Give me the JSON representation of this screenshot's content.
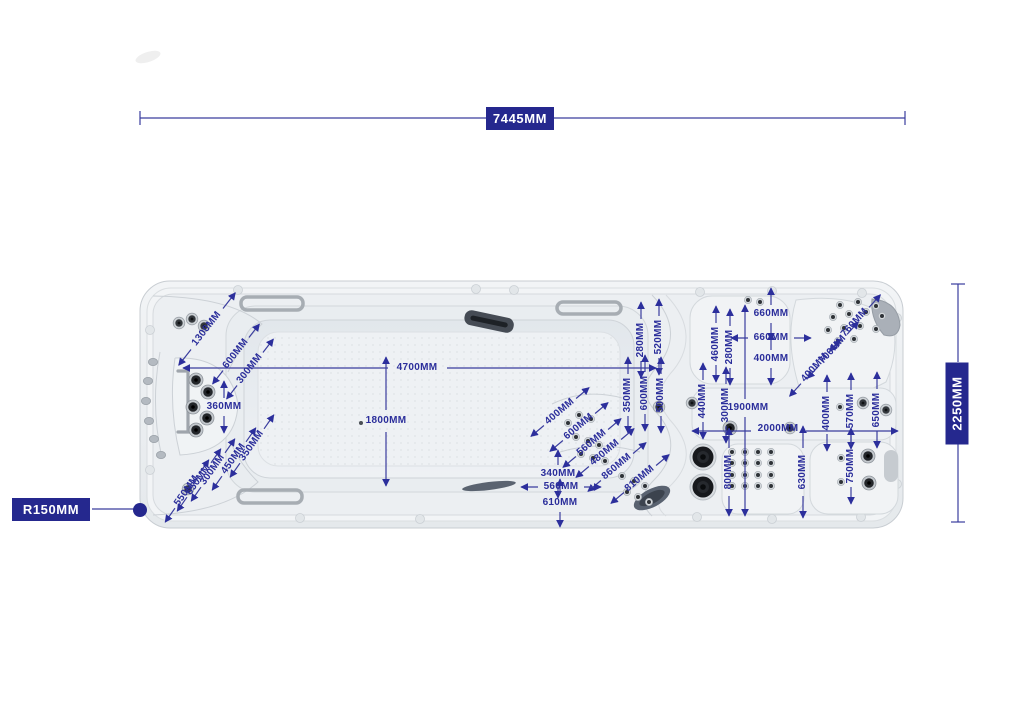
{
  "title": "Swim spa top-view dimension diagram",
  "colors": {
    "dimension_text": "#2b2e9b",
    "dimension_line": "#3a3d9e",
    "box_bg": "#25288e",
    "box_text": "#ffffff",
    "shell": "#eef0f2",
    "outline": "#c8cdd2"
  },
  "overall_dimensions": {
    "length": "7445MM",
    "width": "2250MM",
    "corner_radius": "R150MM"
  },
  "dimension_labels": [
    {
      "label": "1300MM",
      "x": 207,
      "y": 329,
      "r": -52,
      "ar": -52,
      "gap": 26,
      "len": 46
    },
    {
      "label": "600MM",
      "x": 236,
      "y": 354,
      "r": -52,
      "ar": -52,
      "gap": 21,
      "len": 38
    },
    {
      "label": "300MM",
      "x": 250,
      "y": 369,
      "r": -52,
      "ar": -52,
      "gap": 21,
      "len": 38
    },
    {
      "label": "360MM",
      "x": 224,
      "y": 407,
      "r": 0,
      "ar": -90,
      "gap": 9,
      "len": 26
    },
    {
      "label": "4700MM",
      "x": 417,
      "y": 368,
      "r": 0,
      "arrows": false
    },
    {
      "label": "1800MM",
      "x": 386,
      "y": 421,
      "r": 0,
      "arrows": false
    },
    {
      "label": "350MM",
      "x": 252,
      "y": 446,
      "r": -55,
      "ar": -55,
      "gap": 21,
      "len": 38
    },
    {
      "label": "450MM",
      "x": 234,
      "y": 459,
      "r": -55,
      "ar": -55,
      "gap": 21,
      "len": 38
    },
    {
      "label": "300MM",
      "x": 213,
      "y": 470,
      "r": -55,
      "ar": -55,
      "gap": 21,
      "len": 38
    },
    {
      "label": "650MM",
      "x": 199,
      "y": 480,
      "r": -55,
      "ar": -55,
      "gap": 21,
      "len": 38
    },
    {
      "label": "550MM",
      "x": 187,
      "y": 491,
      "r": -55,
      "ar": -55,
      "gap": 21,
      "len": 38
    },
    {
      "label": "280MM",
      "x": 641,
      "y": 340,
      "r": -90,
      "ar": -90,
      "gap": 21,
      "len": 38
    },
    {
      "label": "520MM",
      "x": 659,
      "y": 337,
      "r": -90,
      "ar": -90,
      "gap": 21,
      "len": 38
    },
    {
      "label": "350MM",
      "x": 628,
      "y": 395,
      "r": -90,
      "ar": -90,
      "gap": 21,
      "len": 38
    },
    {
      "label": "600MM",
      "x": 645,
      "y": 393,
      "r": -90,
      "ar": -90,
      "gap": 21,
      "len": 38
    },
    {
      "label": "500MM",
      "x": 661,
      "y": 395,
      "r": -90,
      "ar": -90,
      "gap": 21,
      "len": 38
    },
    {
      "label": "400MM",
      "x": 560,
      "y": 412,
      "r": -40,
      "ar": -40,
      "gap": 21,
      "len": 38
    },
    {
      "label": "600MM",
      "x": 579,
      "y": 427,
      "r": -40,
      "ar": -40,
      "gap": 21,
      "len": 38
    },
    {
      "label": "560MM",
      "x": 592,
      "y": 443,
      "r": -40,
      "ar": -40,
      "gap": 21,
      "len": 38
    },
    {
      "label": "480MM",
      "x": 605,
      "y": 453,
      "r": -40,
      "ar": -40,
      "gap": 21,
      "len": 38
    },
    {
      "label": "860MM",
      "x": 617,
      "y": 467,
      "r": -40,
      "ar": -40,
      "gap": 21,
      "len": 38
    },
    {
      "label": "810MM",
      "x": 640,
      "y": 479,
      "r": -40,
      "ar": -40,
      "gap": 21,
      "len": 38
    },
    {
      "label": "340MM",
      "x": 558,
      "y": 474,
      "r": 0,
      "ar": -90,
      "gap": 9,
      "len": 24
    },
    {
      "label": "560MM",
      "x": 561,
      "y": 487,
      "r": 0,
      "ar": 0,
      "gap": 23,
      "len": 40
    },
    {
      "label": "610MM",
      "x": 560,
      "y": 503,
      "r": 0,
      "ar": -90,
      "gap": 9,
      "len": 24
    },
    {
      "label": "660MM",
      "x": 771,
      "y": 314,
      "r": 0,
      "ar": -90,
      "gap": 9,
      "len": 26
    },
    {
      "label": "660MM",
      "x": 771,
      "y": 338,
      "r": 0,
      "ar": 0,
      "gap": 23,
      "len": 40
    },
    {
      "label": "400MM",
      "x": 771,
      "y": 359,
      "r": 0,
      "ar": -90,
      "gap": 9,
      "len": 26
    },
    {
      "label": "460MM",
      "x": 716,
      "y": 344,
      "r": -90,
      "ar": -90,
      "gap": 21,
      "len": 38
    },
    {
      "label": "280MM",
      "x": 730,
      "y": 347,
      "r": -90,
      "ar": -90,
      "gap": 21,
      "len": 38
    },
    {
      "label": "440MM",
      "x": 703,
      "y": 401,
      "r": -90,
      "ar": -90,
      "gap": 21,
      "len": 38
    },
    {
      "label": "300MM",
      "x": 726,
      "y": 405,
      "r": -90,
      "ar": -90,
      "gap": 21,
      "len": 38
    },
    {
      "label": "1900MM",
      "x": 748,
      "y": 408,
      "r": 0,
      "arrows": false
    },
    {
      "label": "2000MM",
      "x": 778,
      "y": 429,
      "r": 0,
      "arrows": false
    },
    {
      "label": "760MM",
      "x": 855,
      "y": 323,
      "r": -48,
      "ar": -48,
      "gap": 21,
      "len": 38
    },
    {
      "label": "700MM",
      "x": 833,
      "y": 350,
      "r": -48,
      "ar": -48,
      "gap": 21,
      "len": 38
    },
    {
      "label": "400MM",
      "x": 815,
      "y": 368,
      "r": -48,
      "ar": -48,
      "gap": 21,
      "len": 38
    },
    {
      "label": "400MM",
      "x": 827,
      "y": 413,
      "r": -90,
      "ar": -90,
      "gap": 21,
      "len": 38
    },
    {
      "label": "570MM",
      "x": 851,
      "y": 411,
      "r": -90,
      "ar": -90,
      "gap": 21,
      "len": 38
    },
    {
      "label": "650MM",
      "x": 877,
      "y": 410,
      "r": -90,
      "ar": -90,
      "gap": 21,
      "len": 38
    },
    {
      "label": "800MM",
      "x": 729,
      "y": 472,
      "r": -90,
      "ar": -90,
      "gap": 24,
      "len": 44
    },
    {
      "label": "630MM",
      "x": 803,
      "y": 472,
      "r": -90,
      "ar": -90,
      "gap": 24,
      "len": 46
    },
    {
      "label": "750MM",
      "x": 851,
      "y": 466,
      "r": -90,
      "ar": -90,
      "gap": 21,
      "len": 38
    }
  ],
  "dimension_lines": [
    {
      "x1": 140,
      "y1": 118,
      "x2": 487,
      "y2": 118
    },
    {
      "x1": 553,
      "y1": 118,
      "x2": 905,
      "y2": 118
    },
    {
      "x1": 140,
      "y1": 111,
      "x2": 140,
      "y2": 125
    },
    {
      "x1": 905,
      "y1": 111,
      "x2": 905,
      "y2": 125
    },
    {
      "x1": 958,
      "y1": 284,
      "x2": 958,
      "y2": 362
    },
    {
      "x1": 958,
      "y1": 444,
      "x2": 958,
      "y2": 522
    },
    {
      "x1": 951,
      "y1": 284,
      "x2": 965,
      "y2": 284
    },
    {
      "x1": 951,
      "y1": 522,
      "x2": 965,
      "y2": 522
    },
    {
      "x1": 92,
      "y1": 509,
      "x2": 136,
      "y2": 509
    },
    {
      "x1": 388,
      "y1": 368,
      "x2": 183,
      "y2": 368,
      "m": "end"
    },
    {
      "x1": 447,
      "y1": 368,
      "x2": 656,
      "y2": 368,
      "m": "end"
    },
    {
      "x1": 386,
      "y1": 410,
      "x2": 386,
      "y2": 357,
      "m": "end"
    },
    {
      "x1": 386,
      "y1": 432,
      "x2": 386,
      "y2": 486,
      "m": "end"
    },
    {
      "x1": 745,
      "y1": 399,
      "x2": 745,
      "y2": 305,
      "m": "end"
    },
    {
      "x1": 745,
      "y1": 417,
      "x2": 745,
      "y2": 516,
      "m": "end"
    },
    {
      "x1": 751,
      "y1": 431,
      "x2": 692,
      "y2": 431,
      "m": "end"
    },
    {
      "x1": 806,
      "y1": 431,
      "x2": 898,
      "y2": 431,
      "m": "end"
    }
  ],
  "leader_dots": [
    {
      "x": 140,
      "y": 510,
      "r": 7
    }
  ]
}
